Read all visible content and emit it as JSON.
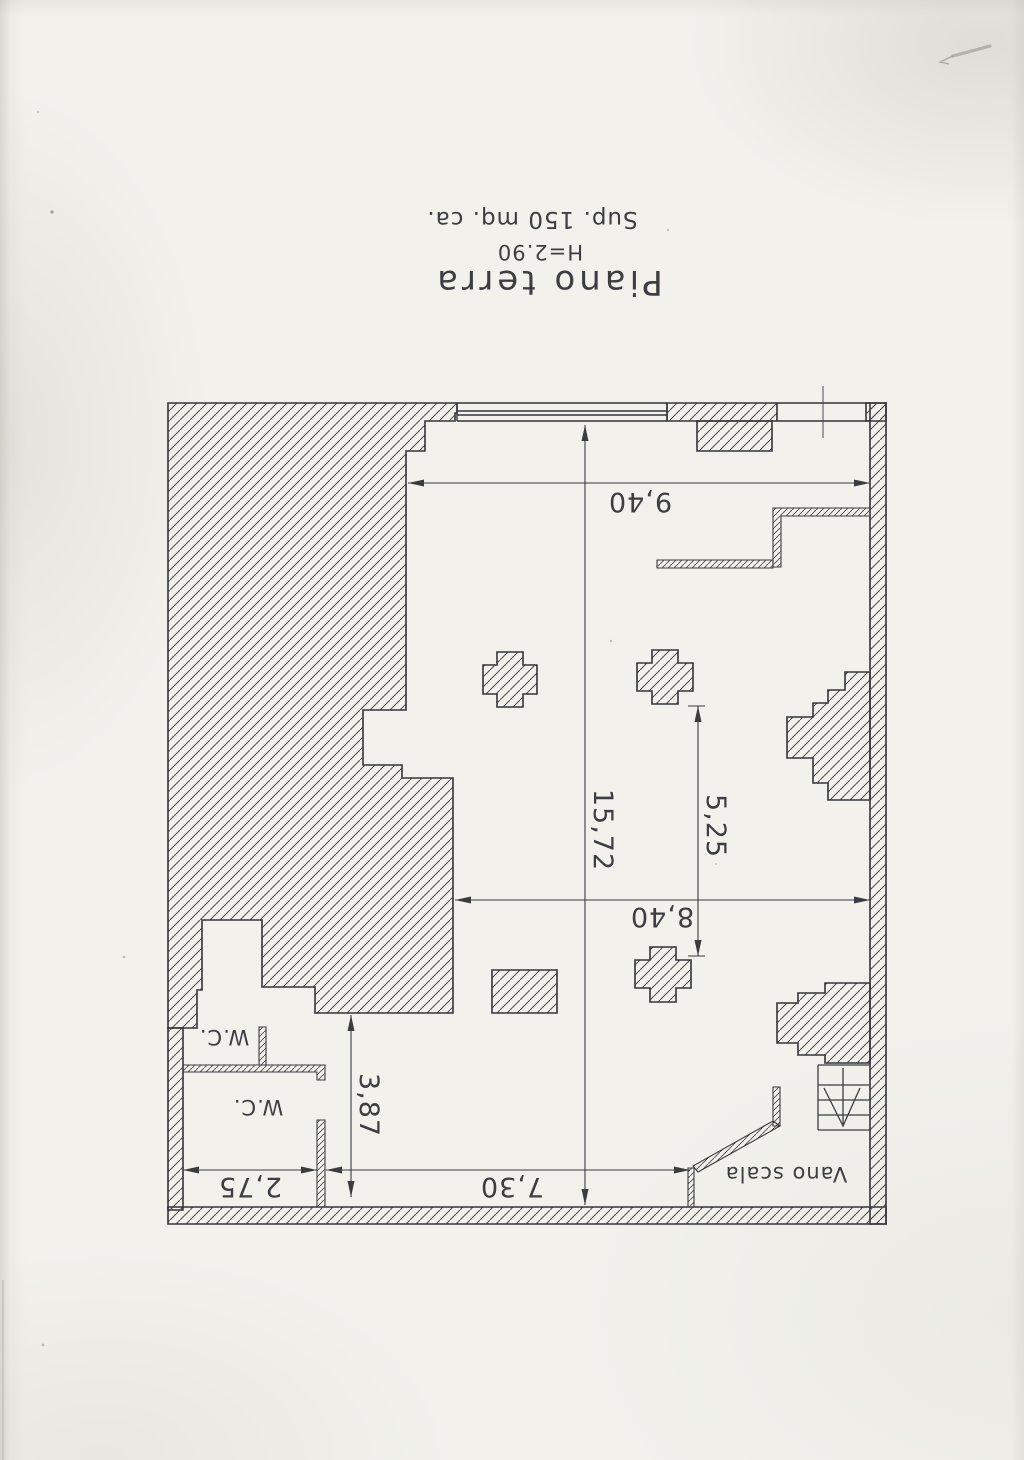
{
  "sheet": {
    "title": "Piano terra",
    "height_note": "H=2.90",
    "area_note": "Sup. 150 mq. ca."
  },
  "plan": {
    "labels": {
      "wc_upper": "W.C.",
      "wc_lower": "W.C.",
      "stair_hall": "Vano scala"
    },
    "dimensions": {
      "top_width": "9,40",
      "overall_depth": "15,72",
      "columns_span": "5,25",
      "main_width": "8,40",
      "service_depth": "3,87",
      "wc_width": "2,75",
      "hall_width": "7,30"
    }
  },
  "colors": {
    "ink": "#34363a",
    "paper": "#f2f1ec"
  }
}
